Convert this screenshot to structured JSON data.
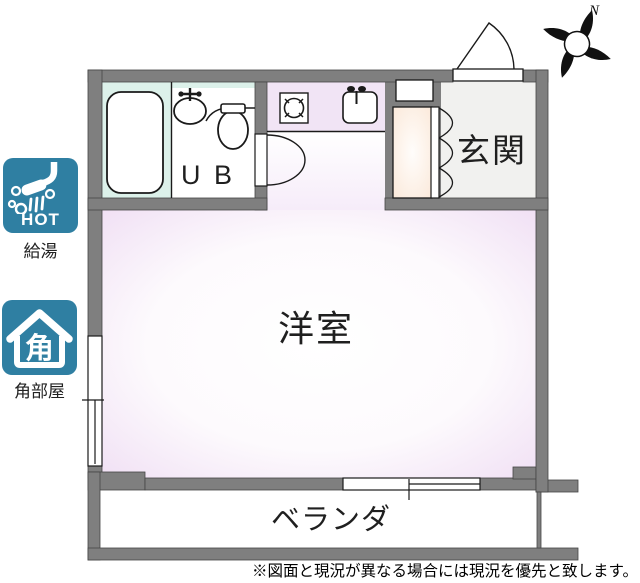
{
  "plan": {
    "rooms": {
      "unit_bath": {
        "label": "U B"
      },
      "entrance": {
        "label": "玄関"
      },
      "western_room": {
        "label": "洋室"
      },
      "veranda": {
        "label": "ベランダ"
      }
    },
    "compass": {
      "label": "N"
    },
    "colors": {
      "wall_gray": "#7f7f7f",
      "ub_mint": "#dcf1ea",
      "room_lavender_edge": "#f0dff4",
      "entrance_gray": "#f1f1ef",
      "closet_cream": "#fbefe4",
      "accent_teal": "#2F7FA2",
      "line_black": "#1a1a1a"
    }
  },
  "badges": [
    {
      "icon": "shower-hot-icon",
      "icon_text": "HOT",
      "label": "給湯"
    },
    {
      "icon": "corner-room-house-icon",
      "icon_char": "角",
      "label": "角部屋"
    }
  ],
  "footer": {
    "disclaimer": "※図面と現況が異なる場合には現況を優先と致します。"
  }
}
